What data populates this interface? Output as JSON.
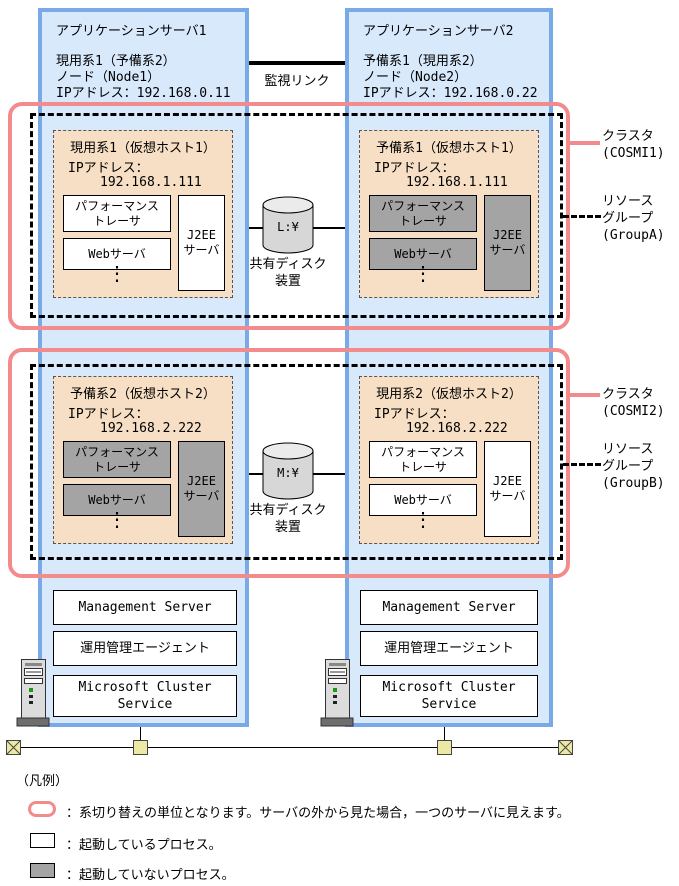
{
  "colors": {
    "server_border": "#7aa9e8",
    "server_fill": "#d9e9fc",
    "host_fill": "#f6dfc4",
    "process_stopped_fill": "#a4a4a4",
    "cluster_outline": "#f28b8b",
    "network_node_fill": "#ece8a6"
  },
  "monitor_link": {
    "label": "監視リンク"
  },
  "servers": [
    {
      "title": "アプリケーションサーバ1",
      "role": "現用系1（予備系2）",
      "node": "ノード（Node1）",
      "ip": "IPアドレス：192.168.0.11",
      "stack": [
        "Management Server",
        "運用管理エージェント",
        "Microsoft Cluster Service"
      ]
    },
    {
      "title": "アプリケーションサーバ2",
      "role": "予備系1（現用系2）",
      "node": "ノード（Node2）",
      "ip": "IPアドレス：192.168.0.22",
      "stack": [
        "Management Server",
        "運用管理エージェント",
        "Microsoft Cluster Service"
      ]
    }
  ],
  "clusters": [
    {
      "cluster_label": [
        "クラスタ",
        "(COSMI1)"
      ],
      "group_label": [
        "リソース",
        "グループ",
        "(GroupA)"
      ],
      "disk": {
        "drive": "L:¥",
        "label": [
          "共有ディスク",
          "装置"
        ]
      },
      "hosts": [
        {
          "title": "現用系1（仮想ホスト1）",
          "ip_label": "IPアドレス：",
          "ip": "192.168.1.111",
          "dots": "⋮",
          "processes": [
            {
              "line1": "パフォーマンス",
              "line2": "トレーサ",
              "state": "running"
            },
            {
              "line1": "Webサーバ",
              "line2": "",
              "state": "running"
            },
            {
              "line1": "J2EE",
              "line2": "サーバ",
              "state": "running"
            }
          ]
        },
        {
          "title": "予備系1（仮想ホスト1）",
          "ip_label": "IPアドレス：",
          "ip": "192.168.1.111",
          "dots": "⋮",
          "processes": [
            {
              "line1": "パフォーマンス",
              "line2": "トレーサ",
              "state": "stopped"
            },
            {
              "line1": "Webサーバ",
              "line2": "",
              "state": "stopped"
            },
            {
              "line1": "J2EE",
              "line2": "サーバ",
              "state": "stopped"
            }
          ]
        }
      ]
    },
    {
      "cluster_label": [
        "クラスタ",
        "(COSMI2)"
      ],
      "group_label": [
        "リソース",
        "グループ",
        "(GroupB)"
      ],
      "disk": {
        "drive": "M:¥",
        "label": [
          "共有ディスク",
          "装置"
        ]
      },
      "hosts": [
        {
          "title": "予備系2（仮想ホスト2）",
          "ip_label": "IPアドレス：",
          "ip": "192.168.2.222",
          "dots": "⋮",
          "processes": [
            {
              "line1": "パフォーマンス",
              "line2": "トレーサ",
              "state": "stopped"
            },
            {
              "line1": "Webサーバ",
              "line2": "",
              "state": "stopped"
            },
            {
              "line1": "J2EE",
              "line2": "サーバ",
              "state": "stopped"
            }
          ]
        },
        {
          "title": "現用系2（仮想ホスト2）",
          "ip_label": "IPアドレス：",
          "ip": "192.168.2.222",
          "dots": "⋮",
          "processes": [
            {
              "line1": "パフォーマンス",
              "line2": "トレーサ",
              "state": "running"
            },
            {
              "line1": "Webサーバ",
              "line2": "",
              "state": "running"
            },
            {
              "line1": "J2EE",
              "line2": "サーバ",
              "state": "running"
            }
          ]
        }
      ]
    }
  ],
  "legend": {
    "title": "（凡例）",
    "items": [
      {
        "text": "：系切り替えの単位となります。サーバの外から見た場合，一つのサーバに見えます。"
      },
      {
        "text": "：起動しているプロセス。"
      },
      {
        "text": "：起動していないプロセス。"
      }
    ]
  }
}
